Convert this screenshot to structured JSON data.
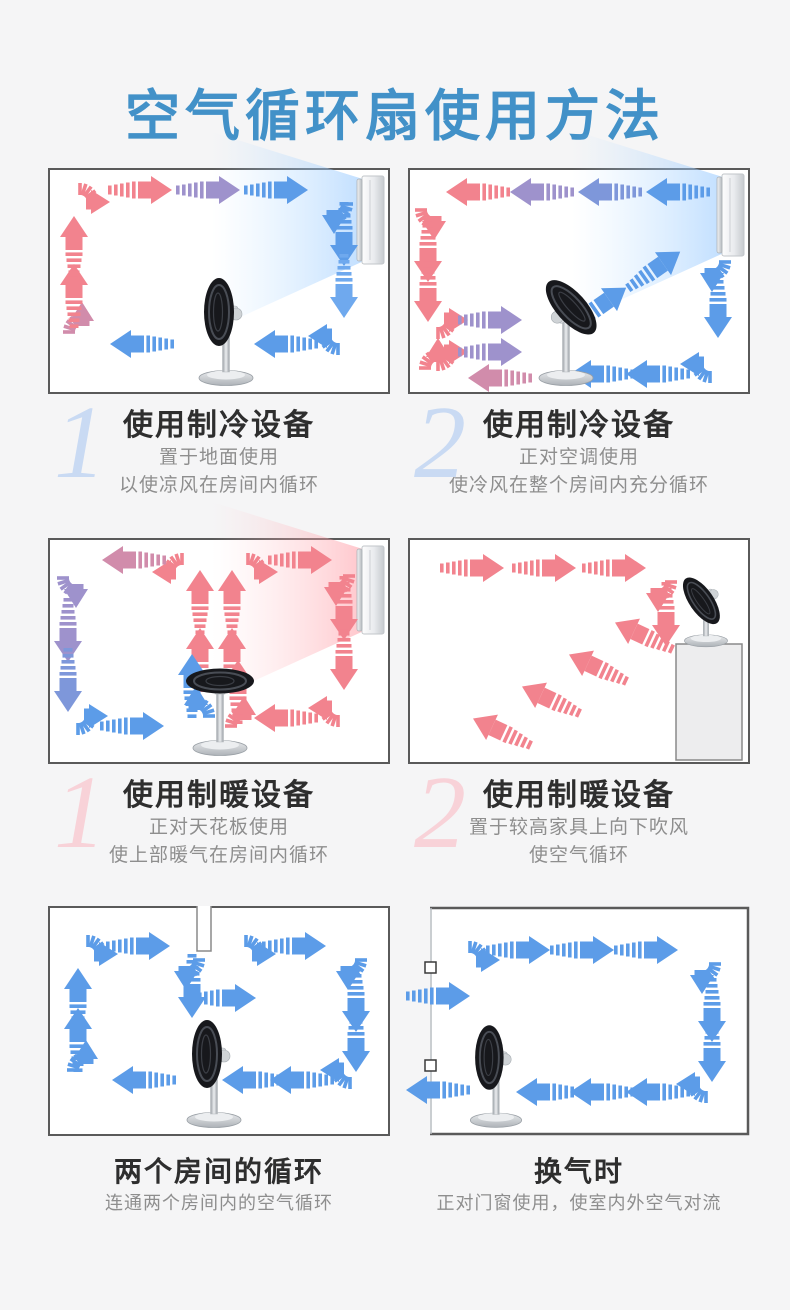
{
  "title": {
    "text": "空气循环扇使用方法",
    "color": "#4291c8"
  },
  "palette": {
    "R": "#f2838e",
    "P1": "#d18cab",
    "P2": "#9e92cc",
    "B1": "#7e97da",
    "B": "#5c9ce8",
    "LB": "#6fa9ee",
    "panel_border": "#5a5a5a",
    "panel_bg": "#ffffff",
    "page_bg": "#f5f5f6"
  },
  "sections": [
    {
      "number": "1",
      "number_color": "#c9daf3",
      "title": "使用制冷设备",
      "sub": [
        "置于地面使用",
        "以使凉风在房间内循环"
      ]
    },
    {
      "number": "2",
      "number_color": "#c9daf3",
      "title": "使用制冷设备",
      "sub": [
        "正对空调使用",
        "使冷风在整个房间内充分循环"
      ]
    },
    {
      "number": "1",
      "number_color": "#f8d2d8",
      "title": "使用制暖设备",
      "sub": [
        "正对天花板使用",
        "使上部暖气在房间内循环"
      ]
    },
    {
      "number": "2",
      "number_color": "#f8d2d8",
      "title": "使用制暖设备",
      "sub": [
        "置于较高家具上向下吹风",
        "使空气循环"
      ]
    },
    {
      "number": "",
      "number_color": "",
      "title": "两个房间的循环",
      "sub": [
        "连通两个房间内的空气循环"
      ]
    },
    {
      "number": "",
      "number_color": "",
      "title": "换气时",
      "sub": [
        "正对门窗使用，使室内外空气对流"
      ]
    }
  ],
  "panels": [
    {
      "h": 226,
      "room": "box",
      "devices": [
        {
          "type": "ac",
          "name": "air-conditioner",
          "x": 314,
          "y": 8,
          "h": 88
        }
      ],
      "fan": {
        "name": "circulation-fan",
        "x": 178,
        "y": 214,
        "pose": "left",
        "scale": 1
      },
      "arrows": [
        [
          "c",
          32,
          34,
          0,
          "R"
        ],
        [
          "s",
          92,
          22,
          0,
          "R"
        ],
        [
          "s",
          160,
          22,
          0,
          "P2"
        ],
        [
          "s",
          228,
          22,
          0,
          "B"
        ],
        [
          "c",
          286,
          36,
          90,
          "B"
        ],
        [
          "s",
          296,
          66,
          90,
          "B"
        ],
        [
          "s",
          296,
          118,
          90,
          "LB"
        ],
        [
          "c",
          290,
          168,
          180,
          "B"
        ],
        [
          "s",
          238,
          176,
          180,
          "B"
        ],
        [
          "s",
          94,
          176,
          180,
          "B"
        ],
        [
          "c",
          34,
          164,
          270,
          "P1"
        ],
        [
          "s",
          26,
          128,
          270,
          "R"
        ],
        [
          "s",
          26,
          80,
          270,
          "R"
        ]
      ]
    },
    {
      "h": 226,
      "room": "box",
      "devices": [
        {
          "type": "ac",
          "name": "air-conditioner",
          "x": 314,
          "y": 6,
          "h": 82
        }
      ],
      "fan": {
        "name": "circulation-fan",
        "x": 158,
        "y": 214,
        "pose": "tilt-up",
        "scale": 1
      },
      "arrows": [
        [
          "s",
          270,
          24,
          180,
          "B"
        ],
        [
          "s",
          202,
          24,
          180,
          "B1"
        ],
        [
          "s",
          134,
          24,
          180,
          "P2"
        ],
        [
          "s",
          70,
          24,
          180,
          "R"
        ],
        [
          "c",
          26,
          42,
          270,
          "R",
          1
        ],
        [
          "s",
          20,
          82,
          90,
          "R"
        ],
        [
          "s",
          20,
          122,
          90,
          "R"
        ],
        [
          "c",
          30,
          152,
          180,
          "R",
          1
        ],
        [
          "s",
          82,
          152,
          0,
          "P2"
        ],
        [
          "c",
          30,
          184,
          180,
          "R",
          1
        ],
        [
          "s",
          82,
          184,
          0,
          "P2"
        ],
        [
          "s",
          92,
          210,
          180,
          "P1"
        ],
        [
          "c",
          30,
          200,
          270,
          "R"
        ],
        [
          "s",
          192,
          138,
          -35,
          "B"
        ],
        [
          "s",
          246,
          102,
          -35,
          "B"
        ],
        [
          "c",
          304,
          94,
          90,
          "B"
        ],
        [
          "s",
          310,
          138,
          90,
          "B"
        ],
        [
          "c",
          302,
          196,
          180,
          "B"
        ],
        [
          "s",
          250,
          206,
          180,
          "B"
        ],
        [
          "s",
          194,
          206,
          180,
          "B"
        ]
      ]
    },
    {
      "h": 226,
      "room": "box",
      "devices": [
        {
          "type": "heater",
          "name": "wall-heater",
          "x": 314,
          "y": 8,
          "h": 88
        }
      ],
      "fan": {
        "name": "circulation-fan",
        "x": 172,
        "y": 214,
        "pose": "up",
        "scale": 1
      },
      "arrows": [
        [
          "s",
          152,
          64,
          270,
          "R"
        ],
        [
          "s",
          184,
          64,
          270,
          "R"
        ],
        [
          "s",
          152,
          122,
          270,
          "R"
        ],
        [
          "s",
          184,
          122,
          270,
          "R"
        ],
        [
          "c",
          134,
          34,
          0,
          "R",
          1
        ],
        [
          "c",
          200,
          34,
          0,
          "R"
        ],
        [
          "s",
          252,
          22,
          0,
          "R"
        ],
        [
          "c",
          288,
          38,
          90,
          "R"
        ],
        [
          "s",
          296,
          70,
          90,
          "R"
        ],
        [
          "s",
          296,
          120,
          90,
          "R"
        ],
        [
          "c",
          290,
          170,
          180,
          "R"
        ],
        [
          "s",
          238,
          180,
          180,
          "R"
        ],
        [
          "c",
          196,
          188,
          270,
          "R"
        ],
        [
          "s",
          190,
          154,
          270,
          "R"
        ],
        [
          "s",
          86,
          22,
          180,
          "P1"
        ],
        [
          "c",
          28,
          40,
          270,
          "P2",
          1
        ],
        [
          "s",
          20,
          92,
          90,
          "P2"
        ],
        [
          "s",
          20,
          142,
          90,
          "B1"
        ],
        [
          "c",
          30,
          178,
          180,
          "B",
          1
        ],
        [
          "s",
          84,
          188,
          0,
          "B"
        ],
        [
          "c",
          148,
          178,
          90,
          "B",
          1
        ],
        [
          "s",
          144,
          148,
          270,
          "B"
        ]
      ]
    },
    {
      "h": 226,
      "room": "box",
      "devices": [
        {
          "type": "furniture",
          "name": "tall-furniture",
          "x": 268,
          "y": 106,
          "w": 66,
          "h": 116
        }
      ],
      "fan": {
        "name": "circulation-fan",
        "x": 298,
        "y": 106,
        "pose": "tilt-down",
        "scale": 0.8
      },
      "arrows": [
        [
          "s",
          64,
          30,
          0,
          "R"
        ],
        [
          "s",
          136,
          30,
          0,
          "R"
        ],
        [
          "s",
          206,
          30,
          0,
          "R"
        ],
        [
          "c",
          250,
          44,
          90,
          "R"
        ],
        [
          "s",
          258,
          76,
          90,
          "R"
        ],
        [
          "s",
          236,
          98,
          205,
          "R"
        ],
        [
          "s",
          190,
          130,
          205,
          "R"
        ],
        [
          "s",
          143,
          162,
          205,
          "R"
        ],
        [
          "s",
          94,
          194,
          205,
          "R"
        ]
      ]
    },
    {
      "h": 230,
      "room": "box",
      "devices": [
        {
          "type": "partition",
          "name": "room-partition-wall",
          "x": 148,
          "w": 16,
          "h": 45
        }
      ],
      "fan": {
        "name": "circulation-fan",
        "x": 166,
        "y": 218,
        "pose": "left",
        "scale": 1
      },
      "arrows": [
        [
          "c",
          40,
          48,
          0,
          "B"
        ],
        [
          "s",
          90,
          40,
          0,
          "B"
        ],
        [
          "c",
          138,
          54,
          90,
          "B"
        ],
        [
          "s",
          144,
          80,
          90,
          "B"
        ],
        [
          "s",
          176,
          92,
          0,
          "B"
        ],
        [
          "c",
          198,
          48,
          0,
          "B"
        ],
        [
          "s",
          246,
          40,
          0,
          "B"
        ],
        [
          "c",
          300,
          54,
          90,
          "B"
        ],
        [
          "s",
          308,
          94,
          90,
          "B"
        ],
        [
          "s",
          308,
          134,
          90,
          "B"
        ],
        [
          "c",
          302,
          164,
          180,
          "B"
        ],
        [
          "s",
          254,
          174,
          180,
          "B"
        ],
        [
          "s",
          206,
          174,
          180,
          "B"
        ],
        [
          "s",
          96,
          174,
          180,
          "B"
        ],
        [
          "c",
          38,
          164,
          270,
          "B"
        ],
        [
          "s",
          30,
          134,
          270,
          "B"
        ],
        [
          "s",
          30,
          94,
          270,
          "B"
        ]
      ]
    },
    {
      "h": 230,
      "room": "door",
      "door_handles": [
        56,
        154
      ],
      "devices": [
        {
          "type": "door",
          "name": "open-door-window",
          "x": 22
        }
      ],
      "fan": {
        "name": "circulation-fan",
        "x": 88,
        "y": 218,
        "pose": "left",
        "scale": 0.95
      },
      "arrows": [
        [
          "s",
          30,
          90,
          0,
          "B"
        ],
        [
          "c",
          62,
          54,
          0,
          "B"
        ],
        [
          "s",
          110,
          44,
          0,
          "B"
        ],
        [
          "s",
          174,
          44,
          0,
          "B"
        ],
        [
          "s",
          238,
          44,
          0,
          "B"
        ],
        [
          "c",
          294,
          58,
          90,
          "B"
        ],
        [
          "s",
          304,
          104,
          90,
          "B"
        ],
        [
          "s",
          304,
          144,
          90,
          "B"
        ],
        [
          "c",
          298,
          178,
          180,
          "B"
        ],
        [
          "s",
          250,
          186,
          180,
          "B"
        ],
        [
          "s",
          194,
          186,
          180,
          "B"
        ],
        [
          "s",
          140,
          186,
          180,
          "B"
        ],
        [
          "s",
          30,
          184,
          180,
          "B"
        ]
      ]
    }
  ]
}
